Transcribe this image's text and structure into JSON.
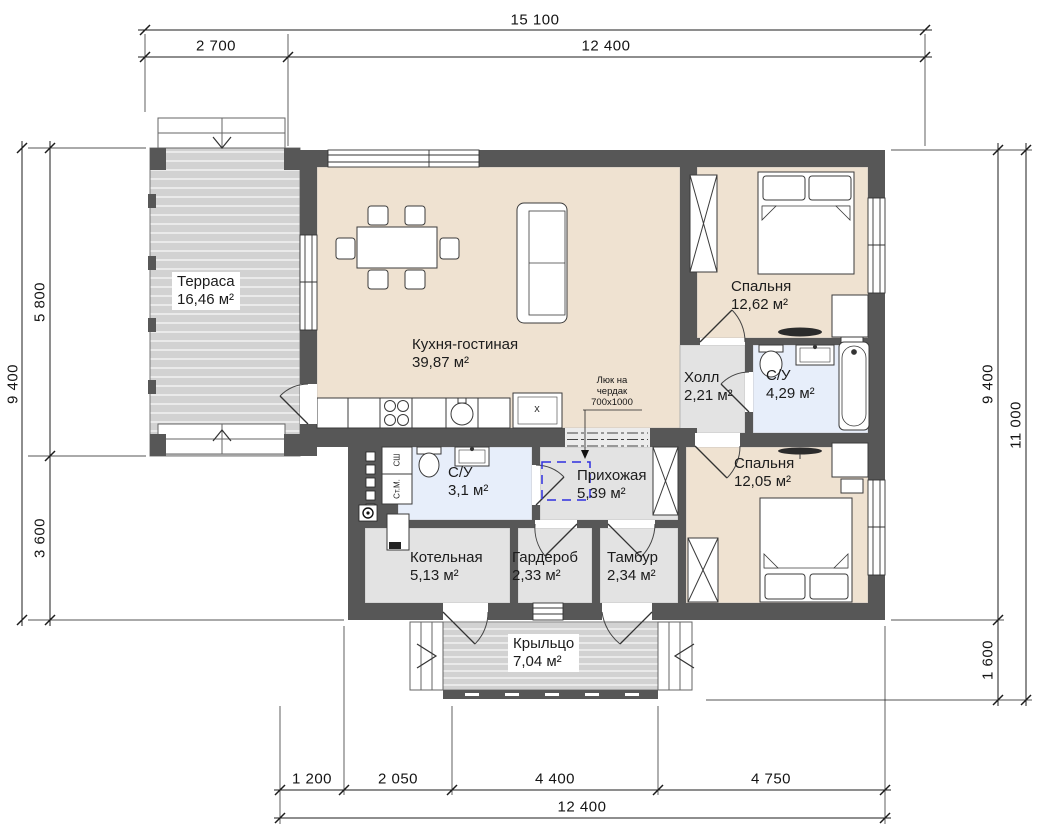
{
  "drawing": {
    "type": "single-storey house floor plan"
  },
  "dimensions": {
    "top_total": "15 100",
    "top_seg1": "2 700",
    "top_seg2": "12 400",
    "left_total": "9 400",
    "left_seg1": "5 800",
    "left_seg2": "3 600",
    "right_seg1": "9 400",
    "right_seg2": "1 600",
    "right_total": "11 000",
    "bottom_seg1": "1 200",
    "bottom_seg2": "2 050",
    "bottom_seg3": "4 400",
    "bottom_seg4": "4 750",
    "bottom_total": "12 400"
  },
  "rooms": {
    "terrace": {
      "name": "Терраса",
      "area": "16,46 м²"
    },
    "kitchen_living": {
      "name": "Кухня-гостиная",
      "area": "39,87 м²"
    },
    "bedroom_top": {
      "name": "Спальня",
      "area": "12,62 м²"
    },
    "hall": {
      "name": "Холл",
      "area": "2,21 м²"
    },
    "bathroom_big": {
      "name": "С/У",
      "area": "4,29 м²"
    },
    "bedroom_bottom": {
      "name": "Спальня",
      "area": "12,05 м²"
    },
    "bathroom_small": {
      "name": "С/У",
      "area": "3,1 м²"
    },
    "entry_hall": {
      "name": "Прихожая",
      "area": "5,39 м²"
    },
    "boiler_room": {
      "name": "Котельная",
      "area": "5,13 м²"
    },
    "wardrobe_room": {
      "name": "Гардероб",
      "area": "2,33 м²"
    },
    "tambour": {
      "name": "Тамбур",
      "area": "2,34 м²"
    },
    "porch": {
      "name": "Крыльцо",
      "area": "7,04 м²"
    }
  },
  "annotations": {
    "attic_hatch_line1": "Люк на",
    "attic_hatch_line2": "чердак",
    "attic_hatch_size": "700x1000",
    "appliance_dryer": "СШ",
    "appliance_washer": "Ст.М.",
    "kitchen_unit_mark": "x"
  },
  "colors": {
    "wall": "#575757",
    "room_warm": "#efe2d1",
    "room_wet": "#e7eefa",
    "room_neutral": "#e3e3e3",
    "deck": "#d2d2d2",
    "hatch_marker": "#2f2fe0"
  }
}
